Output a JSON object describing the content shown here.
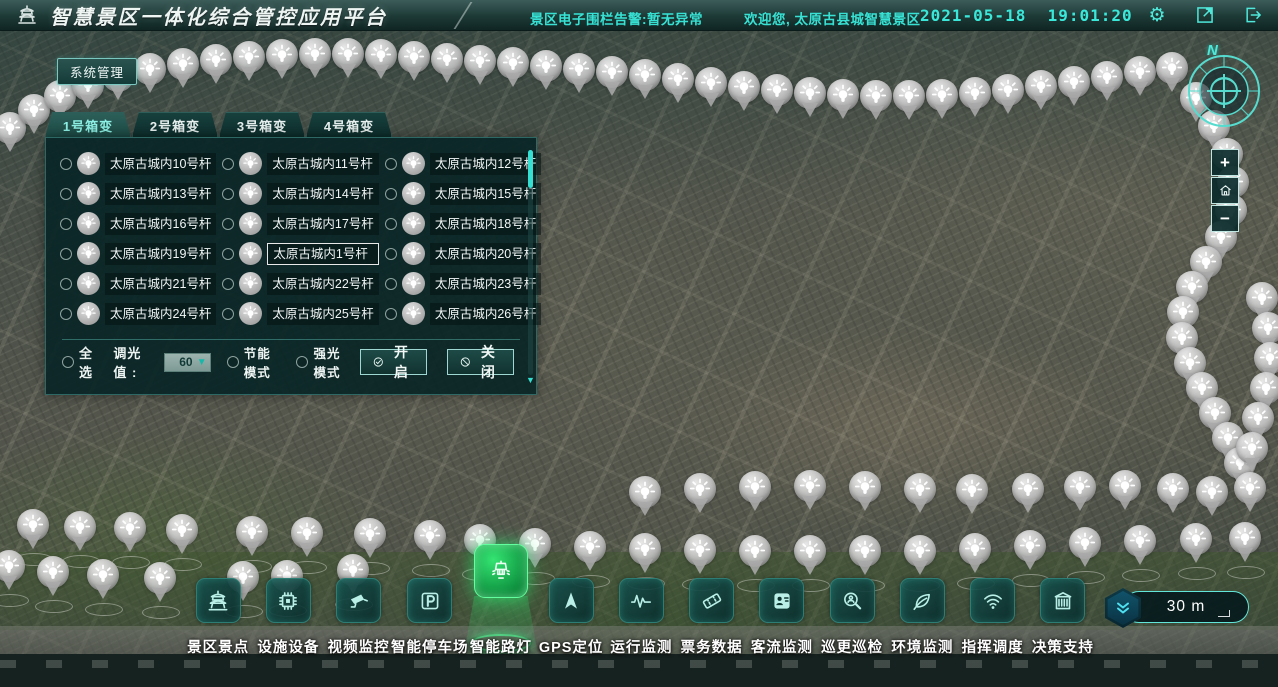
{
  "header": {
    "title": "智慧景区一体化综合管控应用平台",
    "fence_alert": "景区电子围栏告警:暂无异常",
    "welcome": "欢迎您, 太原古县城智慧景区",
    "date": "2021-05-18",
    "time": "19:01:20",
    "icons": [
      "settings-icon",
      "fullscreen-icon",
      "logout-icon"
    ]
  },
  "system_button": {
    "label": "系统管理"
  },
  "light_panel": {
    "tabs": [
      {
        "label": "1号箱变",
        "active": true
      },
      {
        "label": "2号箱变",
        "active": false
      },
      {
        "label": "3号箱变",
        "active": false
      },
      {
        "label": "4号箱变",
        "active": false
      }
    ],
    "lights": [
      {
        "label": "太原古城内10号杆",
        "selected": false
      },
      {
        "label": "太原古城内11号杆",
        "selected": false
      },
      {
        "label": "太原古城内12号杆",
        "selected": false
      },
      {
        "label": "太原古城内13号杆",
        "selected": false
      },
      {
        "label": "太原古城内14号杆",
        "selected": false
      },
      {
        "label": "太原古城内15号杆",
        "selected": false
      },
      {
        "label": "太原古城内16号杆",
        "selected": false
      },
      {
        "label": "太原古城内17号杆",
        "selected": false
      },
      {
        "label": "太原古城内18号杆",
        "selected": false
      },
      {
        "label": "太原古城内19号杆",
        "selected": false
      },
      {
        "label": "太原古城内1号杆",
        "selected": true
      },
      {
        "label": "太原古城内20号杆",
        "selected": false
      },
      {
        "label": "太原古城内21号杆",
        "selected": false
      },
      {
        "label": "太原古城内22号杆",
        "selected": false
      },
      {
        "label": "太原古城内23号杆",
        "selected": false
      },
      {
        "label": "太原古城内24号杆",
        "selected": false
      },
      {
        "label": "太原古城内25号杆",
        "selected": false
      },
      {
        "label": "太原古城内26号杆",
        "selected": false
      }
    ],
    "controls": {
      "select_all": "全选",
      "dim_label": "调光值 :",
      "dim_value": "60",
      "eco_mode": "节能模式",
      "bright_mode": "强光模式",
      "open_btn": "开启",
      "close_btn": "关闭"
    }
  },
  "toolbar": {
    "items": [
      {
        "label": "景区景点",
        "icon": "pagoda-icon",
        "active": false
      },
      {
        "label": "设施设备",
        "icon": "chip-icon",
        "active": false
      },
      {
        "label": "视频监控",
        "icon": "cctv-camera-icon",
        "active": false
      },
      {
        "label": "智能停车场",
        "icon": "parking-icon",
        "active": false
      },
      {
        "label": "智能路灯",
        "icon": "street-lamp-icon",
        "active": true
      },
      {
        "label": "GPS定位",
        "icon": "gps-arrow-icon",
        "active": false
      },
      {
        "label": "运行监测",
        "icon": "waveform-icon",
        "active": false
      },
      {
        "label": "票务数据",
        "icon": "ticket-icon",
        "active": false
      },
      {
        "label": "客流监测",
        "icon": "visitor-card-icon",
        "active": false
      },
      {
        "label": "巡更巡检",
        "icon": "patrol-magnifier-icon",
        "active": false
      },
      {
        "label": "环境监测",
        "icon": "leaf-icon",
        "active": false
      },
      {
        "label": "指挥调度",
        "icon": "wifi-icon",
        "active": false
      },
      {
        "label": "决策支持",
        "icon": "building-icon",
        "active": false
      }
    ]
  },
  "map": {
    "compass_label": "N",
    "zoom_in_label": "+",
    "zoom_out_label": "−",
    "scale_label": "30 m",
    "pins": [
      [
        10,
        128
      ],
      [
        34,
        110
      ],
      [
        60,
        96
      ],
      [
        88,
        85
      ],
      [
        118,
        76
      ],
      [
        150,
        69
      ],
      [
        183,
        64
      ],
      [
        216,
        60
      ],
      [
        249,
        57
      ],
      [
        282,
        55
      ],
      [
        315,
        54
      ],
      [
        348,
        54
      ],
      [
        381,
        55
      ],
      [
        414,
        57
      ],
      [
        447,
        59
      ],
      [
        480,
        61
      ],
      [
        513,
        63
      ],
      [
        546,
        66
      ],
      [
        579,
        69
      ],
      [
        612,
        72
      ],
      [
        645,
        75
      ],
      [
        678,
        79
      ],
      [
        711,
        83
      ],
      [
        744,
        87
      ],
      [
        777,
        90
      ],
      [
        810,
        93
      ],
      [
        843,
        95
      ],
      [
        876,
        96
      ],
      [
        909,
        96
      ],
      [
        942,
        95
      ],
      [
        975,
        93
      ],
      [
        1008,
        90
      ],
      [
        1041,
        86
      ],
      [
        1074,
        82
      ],
      [
        1107,
        77
      ],
      [
        1140,
        72
      ],
      [
        1172,
        68
      ],
      [
        1196,
        98
      ],
      [
        1214,
        126
      ],
      [
        1227,
        154
      ],
      [
        1233,
        182
      ],
      [
        1231,
        210
      ],
      [
        1221,
        237
      ],
      [
        1206,
        262
      ],
      [
        1192,
        287
      ],
      [
        1183,
        312
      ],
      [
        1182,
        338
      ],
      [
        1190,
        363
      ],
      [
        1202,
        388
      ],
      [
        1215,
        413
      ],
      [
        1228,
        438
      ],
      [
        1240,
        463
      ],
      [
        1250,
        488
      ],
      [
        1262,
        298
      ],
      [
        1268,
        328
      ],
      [
        1270,
        358
      ],
      [
        1266,
        388
      ],
      [
        1258,
        418
      ],
      [
        1252,
        448
      ],
      [
        645,
        492
      ],
      [
        700,
        489
      ],
      [
        755,
        487
      ],
      [
        810,
        486
      ],
      [
        865,
        487
      ],
      [
        920,
        489
      ],
      [
        972,
        490
      ],
      [
        1028,
        489
      ],
      [
        1080,
        487
      ],
      [
        1125,
        486
      ],
      [
        1173,
        489
      ],
      [
        1212,
        492
      ],
      [
        430,
        536
      ],
      [
        480,
        540
      ],
      [
        535,
        544
      ],
      [
        590,
        547
      ],
      [
        645,
        549
      ],
      [
        700,
        550
      ],
      [
        755,
        551
      ],
      [
        810,
        551
      ],
      [
        865,
        551
      ],
      [
        920,
        551
      ],
      [
        975,
        549
      ],
      [
        1030,
        546
      ],
      [
        1085,
        543
      ],
      [
        1140,
        541
      ],
      [
        1196,
        539
      ],
      [
        1245,
        538
      ],
      [
        33,
        525
      ],
      [
        80,
        527
      ],
      [
        130,
        528
      ],
      [
        182,
        530
      ],
      [
        252,
        532
      ],
      [
        307,
        533
      ],
      [
        370,
        534
      ],
      [
        9,
        566
      ],
      [
        53,
        572
      ],
      [
        103,
        575
      ],
      [
        160,
        578
      ],
      [
        243,
        577
      ],
      [
        287,
        576
      ],
      [
        353,
        570
      ]
    ]
  },
  "colors": {
    "accent_cyan": "#37e2d4",
    "active_green": "#2ee06a",
    "panel_bg": "#092526",
    "header_top": "#3c5c59"
  }
}
